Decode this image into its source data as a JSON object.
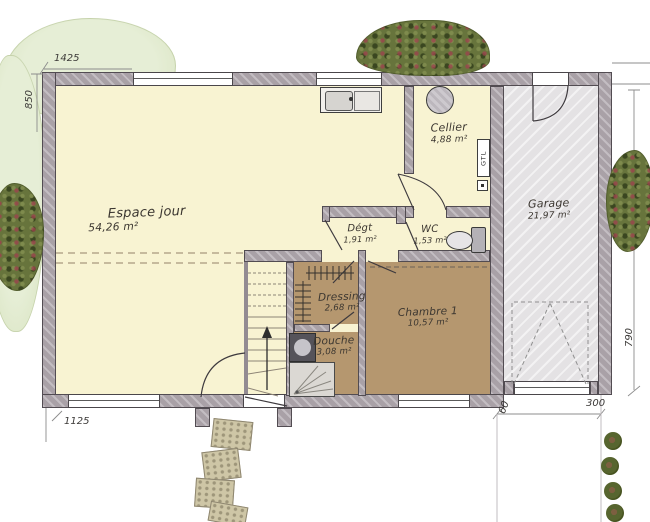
{
  "rooms": {
    "espace_jour": {
      "name": "Espace jour",
      "area": "54,26 m²"
    },
    "cellier": {
      "name": "Cellier",
      "area": "4,88 m²"
    },
    "garage": {
      "name": "Garage",
      "area": "21,97 m²"
    },
    "degt": {
      "name": "Dégt",
      "area": "1,91 m²"
    },
    "wc": {
      "name": "WC",
      "area": "1,53 m²"
    },
    "dressing": {
      "name": "Dressing",
      "area": "2,68 m²"
    },
    "chambre": {
      "name": "Chambre 1",
      "area": "10,57 m²"
    },
    "douche": {
      "name": "Douche",
      "area": "3,08 m²"
    }
  },
  "fixtures": {
    "gtl": "GTL"
  },
  "dimensions": {
    "top_left_width": "1425",
    "left_height": "850",
    "bottom_width": "1125",
    "right_height": "790",
    "garage_width": "300",
    "garage_offset": "60"
  },
  "colors": {
    "floor_day": "#f8f3d2",
    "floor_night": "#b5976f",
    "floor_garage": "#e4e2e4",
    "wall": "#a9a1a7",
    "greenery": "#67743c"
  }
}
